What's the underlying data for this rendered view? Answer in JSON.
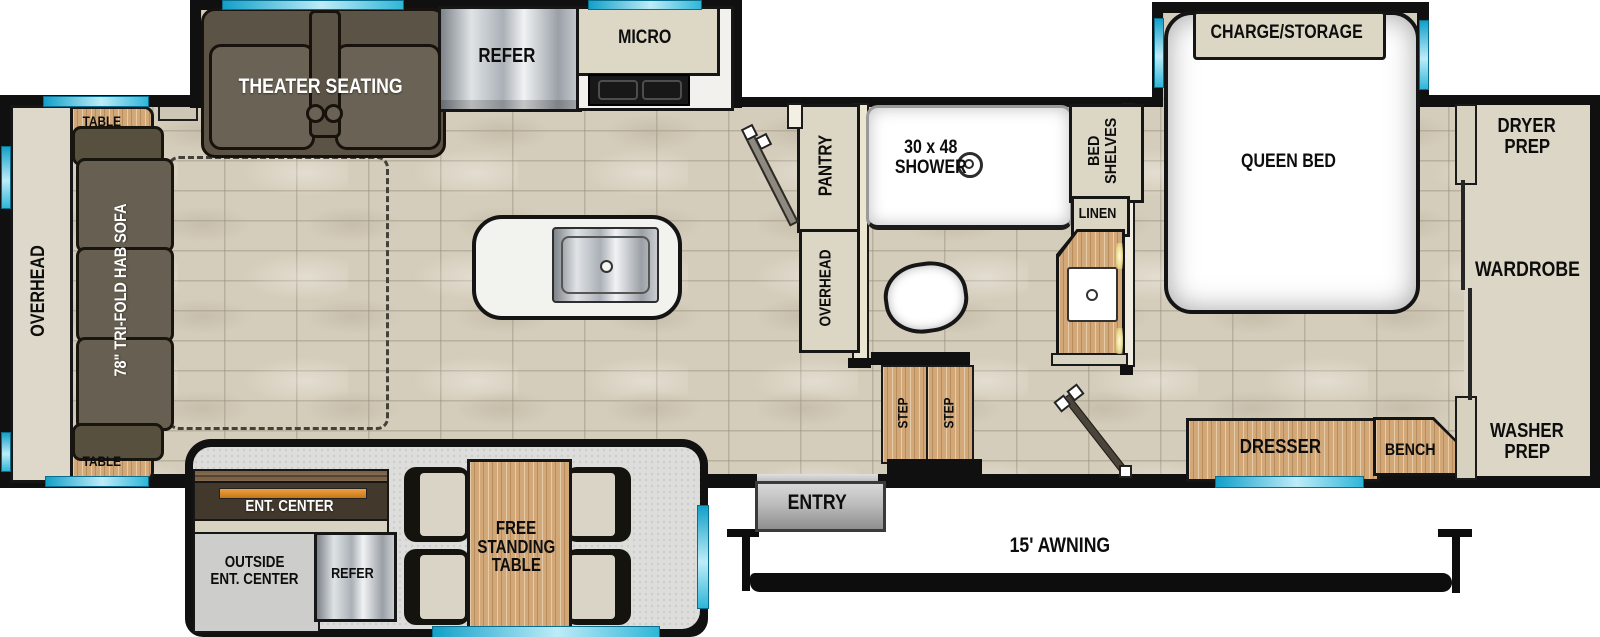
{
  "floorplan": {
    "type": "rv-travel-trailer-floorplan",
    "labels": {
      "overhead_rear": "OVERHEAD",
      "table": "TABLE",
      "sofa": "78\" TRI-FOLD HAB SOFA",
      "theater": "THEATER SEATING",
      "refer": "REFER",
      "micro": "MICRO",
      "pantry": "PANTRY",
      "overhead_bath": "OVERHEAD",
      "shower_l1": "30 x 48",
      "shower_l2": "SHOWER",
      "bed_shelves_l1": "BED",
      "bed_shelves_l2": "SHELVES",
      "linen": "LINEN",
      "charge_storage": "CHARGE/STORAGE",
      "queen_bed": "QUEEN BED",
      "dryer_l1": "DRYER",
      "dryer_l2": "PREP",
      "wardrobe": "WARDROBE",
      "washer_l1": "WASHER",
      "washer_l2": "PREP",
      "dresser": "DRESSER",
      "bench": "BENCH",
      "step": "STEP",
      "entry": "ENTRY",
      "awning": "15' AWNING",
      "ent_center": "ENT. CENTER",
      "outside_l1": "OUTSIDE",
      "outside_l2": "ENT. CENTER",
      "free_table_l1": "FREE",
      "free_table_l2": "STANDING",
      "free_table_l3": "TABLE"
    },
    "colors": {
      "wall": "#101010",
      "window_accent": "#29b7d9",
      "tile_floor": "#d5cdbb",
      "slide_floor_gray": "#dddddb",
      "cabinet_beige": "#dcd6c5",
      "wood": "#d2a878",
      "dark_upholstery": "#5b5346",
      "ent_center_orange": "#e0902e",
      "stainless": "#c9cdd1"
    }
  }
}
